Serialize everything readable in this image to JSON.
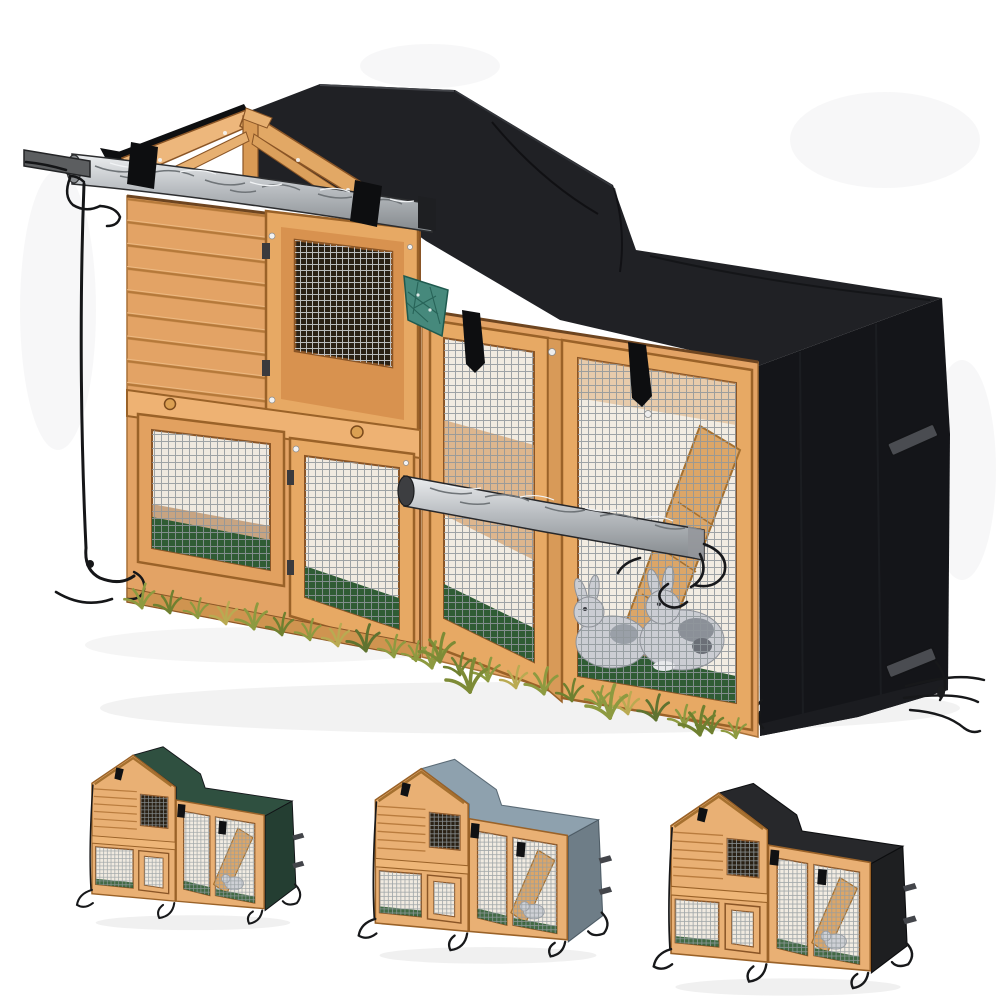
{
  "page": {
    "background_color": "#ffffff"
  },
  "product": {
    "description": "Two-storey wooden rabbit hutch fitted with a waterproof cover; front flaps rolled up, straps and drawstrings visible, two grey rabbits inside the run; three cover colour variants shown below",
    "main_image": {
      "cover": {
        "roof_color": "#202125",
        "side_color": "#141519",
        "strap_color": "#0d0e10",
        "buckle_color": "#4a4c51"
      },
      "hutch": {
        "wood_color": "#e3a365",
        "frame_color": "#9a6228",
        "window_color": "#2a2115"
      },
      "accents": {
        "tarp_roll_color": "#c3c7ca",
        "hay_net_color": "#46897c",
        "grass_color": "#8d9a40",
        "floor_color": "#2f5c34",
        "rabbit_color": "#cbcdd3"
      }
    },
    "variants": [
      {
        "name": "dark-green-cover",
        "cover_color": "#2f5040"
      },
      {
        "name": "grey-cover",
        "cover_color": "#8ea1ae"
      },
      {
        "name": "black-cover",
        "cover_color": "#27282b"
      }
    ]
  }
}
